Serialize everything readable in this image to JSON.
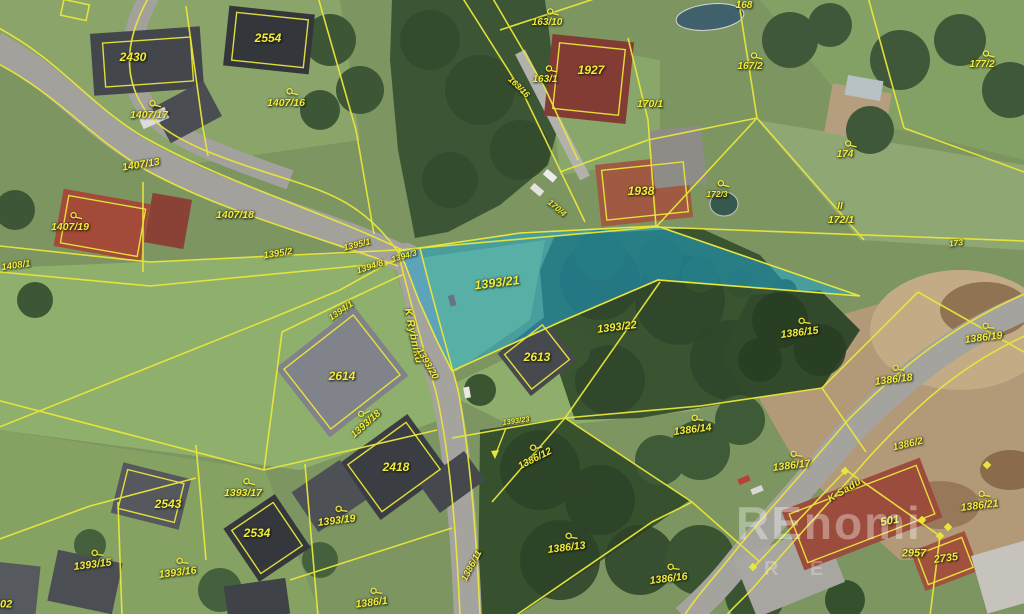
{
  "map": {
    "type": "cadastral-aerial-map",
    "highlighted_parcel": {
      "number": "1393/21",
      "fill": "#1aa4d5"
    },
    "colors": {
      "boundary_line": "#e9e63b",
      "label_text": "#f2ec3e",
      "road": "#a3a19b",
      "highlight": "#1aa4d5"
    },
    "watermark": {
      "line1": "REnomi",
      "line2": "R E"
    },
    "labels": [
      {
        "text": "2430",
        "x": 133,
        "y": 57,
        "rot": 0,
        "size": 12,
        "sym": false,
        "kind": "house"
      },
      {
        "text": "2554",
        "x": 268,
        "y": 38,
        "rot": 0,
        "size": 12,
        "sym": false,
        "kind": "house"
      },
      {
        "text": "1407/17",
        "x": 149,
        "y": 110,
        "rot": 0,
        "size": 10.5,
        "sym": true,
        "kind": "parcel"
      },
      {
        "text": "1407/16",
        "x": 286,
        "y": 98,
        "rot": 0,
        "size": 10.5,
        "sym": true,
        "kind": "parcel"
      },
      {
        "text": "1407/13",
        "x": 141,
        "y": 165,
        "rot": -9,
        "size": 10.5,
        "sym": false,
        "kind": "parcel"
      },
      {
        "text": "1407/19",
        "x": 70,
        "y": 222,
        "rot": 0,
        "size": 10.5,
        "sym": true,
        "kind": "parcel"
      },
      {
        "text": "1407/18",
        "x": 235,
        "y": 215,
        "rot": 0,
        "size": 10.5,
        "sym": false,
        "kind": "parcel"
      },
      {
        "text": "1395/2",
        "x": 278,
        "y": 254,
        "rot": -9,
        "size": 9.5,
        "sym": false,
        "kind": "parcel"
      },
      {
        "text": "1408/1",
        "x": 16,
        "y": 266,
        "rot": -8,
        "size": 9.5,
        "sym": false,
        "kind": "parcel"
      },
      {
        "text": "163/10",
        "x": 547,
        "y": 18,
        "rot": 0,
        "size": 10,
        "sym": true,
        "kind": "parcel"
      },
      {
        "text": "163/1",
        "x": 545,
        "y": 75,
        "rot": 0,
        "size": 10,
        "sym": true,
        "kind": "parcel"
      },
      {
        "text": "163/16",
        "x": 519,
        "y": 87,
        "rot": 44,
        "size": 8.5,
        "sym": false,
        "kind": "parcel"
      },
      {
        "text": "1927",
        "x": 591,
        "y": 70,
        "rot": 0,
        "size": 12,
        "sym": false,
        "kind": "house"
      },
      {
        "text": "170/1",
        "x": 650,
        "y": 104,
        "rot": 0,
        "size": 10.5,
        "sym": false,
        "kind": "parcel"
      },
      {
        "text": "168",
        "x": 744,
        "y": 6,
        "rot": 0,
        "size": 10,
        "sym": false,
        "kind": "parcel"
      },
      {
        "text": "167/2",
        "x": 750,
        "y": 62,
        "rot": 0,
        "size": 10,
        "sym": true,
        "kind": "parcel"
      },
      {
        "text": "177/2",
        "x": 982,
        "y": 60,
        "rot": 0,
        "size": 10,
        "sym": true,
        "kind": "parcel"
      },
      {
        "text": "174",
        "x": 845,
        "y": 150,
        "rot": 0,
        "size": 10,
        "sym": true,
        "kind": "parcel"
      },
      {
        "text": "170/4",
        "x": 557,
        "y": 208,
        "rot": 40,
        "size": 8.5,
        "sym": false,
        "kind": "parcel"
      },
      {
        "text": "172/3",
        "x": 717,
        "y": 189,
        "rot": 0,
        "size": 8.5,
        "sym": true,
        "kind": "parcel"
      },
      {
        "text": "II",
        "x": 840,
        "y": 207,
        "rot": 0,
        "size": 10,
        "sym": false,
        "kind": "mark"
      },
      {
        "text": "172/1",
        "x": 841,
        "y": 220,
        "rot": 0,
        "size": 10.5,
        "sym": false,
        "kind": "parcel"
      },
      {
        "text": "173",
        "x": 956,
        "y": 243,
        "rot": -6,
        "size": 8.5,
        "sym": false,
        "kind": "parcel"
      },
      {
        "text": "1938",
        "x": 641,
        "y": 191,
        "rot": 0,
        "size": 12,
        "sym": false,
        "kind": "house"
      },
      {
        "text": "1395/1",
        "x": 357,
        "y": 245,
        "rot": -14,
        "size": 9,
        "sym": false,
        "kind": "parcel"
      },
      {
        "text": "1394/3",
        "x": 404,
        "y": 256,
        "rot": -16,
        "size": 8.5,
        "sym": false,
        "kind": "parcel"
      },
      {
        "text": "1394/8",
        "x": 370,
        "y": 267,
        "rot": -18,
        "size": 9,
        "sym": false,
        "kind": "parcel"
      },
      {
        "text": "1394/1",
        "x": 341,
        "y": 311,
        "rot": -35,
        "size": 9,
        "sym": false,
        "kind": "parcel"
      },
      {
        "text": "1393/21",
        "x": 497,
        "y": 283,
        "rot": -7,
        "size": 12.5,
        "sym": false,
        "kind": "parcel"
      },
      {
        "text": "1393/22",
        "x": 617,
        "y": 328,
        "rot": -7,
        "size": 11,
        "sym": false,
        "kind": "parcel"
      },
      {
        "text": "2613",
        "x": 537,
        "y": 357,
        "rot": 0,
        "size": 12,
        "sym": false,
        "kind": "house"
      },
      {
        "text": "2614",
        "x": 342,
        "y": 376,
        "rot": 0,
        "size": 12,
        "sym": false,
        "kind": "house"
      },
      {
        "text": "K Rybníku",
        "x": 413,
        "y": 336,
        "rot": 78,
        "size": 10.5,
        "sym": false,
        "kind": "street"
      },
      {
        "text": "1393/20",
        "x": 427,
        "y": 364,
        "rot": 60,
        "size": 9.5,
        "sym": false,
        "kind": "parcel"
      },
      {
        "text": "1393/18",
        "x": 363,
        "y": 421,
        "rot": -42,
        "size": 10,
        "sym": true,
        "kind": "parcel"
      },
      {
        "text": "1386/15",
        "x": 799,
        "y": 328,
        "rot": -7,
        "size": 10.5,
        "sym": true,
        "kind": "parcel"
      },
      {
        "text": "1386/19",
        "x": 983,
        "y": 333,
        "rot": -7,
        "size": 10.5,
        "sym": true,
        "kind": "parcel"
      },
      {
        "text": "1386/18",
        "x": 893,
        "y": 375,
        "rot": -7,
        "size": 10.5,
        "sym": true,
        "kind": "parcel"
      },
      {
        "text": "1386/14",
        "x": 692,
        "y": 425,
        "rot": -7,
        "size": 10.5,
        "sym": true,
        "kind": "parcel"
      },
      {
        "text": "1393/23",
        "x": 516,
        "y": 421,
        "rot": -8,
        "size": 7.5,
        "sym": false,
        "kind": "parcel"
      },
      {
        "text": "1386/12",
        "x": 533,
        "y": 455,
        "rot": -27,
        "size": 10,
        "sym": true,
        "kind": "parcel"
      },
      {
        "text": "2418",
        "x": 396,
        "y": 467,
        "rot": 0,
        "size": 12,
        "sym": false,
        "kind": "house"
      },
      {
        "text": "1386/17",
        "x": 791,
        "y": 461,
        "rot": -7,
        "size": 10.5,
        "sym": true,
        "kind": "parcel"
      },
      {
        "text": "1386/2",
        "x": 908,
        "y": 445,
        "rot": -13,
        "size": 10,
        "sym": false,
        "kind": "parcel"
      },
      {
        "text": "K Sadu",
        "x": 845,
        "y": 491,
        "rot": -31,
        "size": 10,
        "sym": false,
        "kind": "street"
      },
      {
        "text": "1386/21",
        "x": 979,
        "y": 501,
        "rot": -7,
        "size": 10.5,
        "sym": true,
        "kind": "parcel"
      },
      {
        "text": "501",
        "x": 890,
        "y": 522,
        "rot": -10,
        "size": 11.5,
        "sym": false,
        "kind": "house"
      },
      {
        "text": "2957",
        "x": 914,
        "y": 554,
        "rot": 0,
        "size": 11,
        "sym": false,
        "kind": "house"
      },
      {
        "text": "2735",
        "x": 946,
        "y": 559,
        "rot": -8,
        "size": 11,
        "sym": false,
        "kind": "house"
      },
      {
        "text": "1393/17",
        "x": 243,
        "y": 488,
        "rot": 0,
        "size": 10.5,
        "sym": true,
        "kind": "parcel"
      },
      {
        "text": "2543",
        "x": 168,
        "y": 504,
        "rot": 0,
        "size": 12,
        "sym": false,
        "kind": "house"
      },
      {
        "text": "2534",
        "x": 257,
        "y": 533,
        "rot": 0,
        "size": 12,
        "sym": false,
        "kind": "house"
      },
      {
        "text": "1393/19",
        "x": 336,
        "y": 516,
        "rot": -7,
        "size": 10.5,
        "sym": true,
        "kind": "parcel"
      },
      {
        "text": "1393/16",
        "x": 177,
        "y": 568,
        "rot": -7,
        "size": 10.5,
        "sym": true,
        "kind": "parcel"
      },
      {
        "text": "1393/15",
        "x": 92,
        "y": 560,
        "rot": -7,
        "size": 10.5,
        "sym": true,
        "kind": "parcel"
      },
      {
        "text": "1386/11",
        "x": 472,
        "y": 566,
        "rot": -62,
        "size": 9.5,
        "sym": false,
        "kind": "parcel"
      },
      {
        "text": "1386/13",
        "x": 566,
        "y": 543,
        "rot": -7,
        "size": 10.5,
        "sym": true,
        "kind": "parcel"
      },
      {
        "text": "1386/16",
        "x": 668,
        "y": 574,
        "rot": -7,
        "size": 10.5,
        "sym": true,
        "kind": "parcel"
      },
      {
        "text": "1386/1",
        "x": 371,
        "y": 598,
        "rot": -7,
        "size": 10.5,
        "sym": true,
        "kind": "parcel"
      },
      {
        "text": "2502",
        "x": 0,
        "y": 605,
        "rot": 0,
        "size": 11,
        "sym": false,
        "kind": "house"
      }
    ]
  }
}
